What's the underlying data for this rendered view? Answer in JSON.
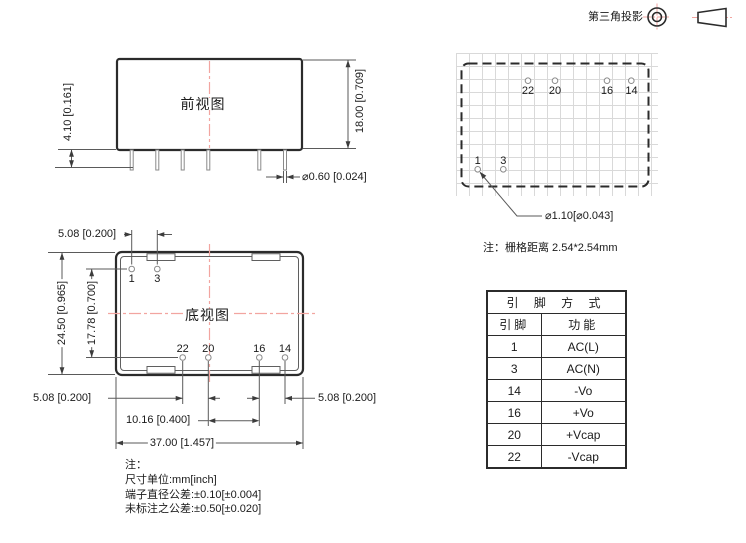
{
  "header": {
    "projection_label": "第三角投影"
  },
  "front_view": {
    "title": "前视图",
    "dim_pin_length": "4.10 [0.161]",
    "dim_body_height": "18.00 [0.709]",
    "dim_pin_diameter": "⌀0.60 [0.024]"
  },
  "grid_view": {
    "top_pin_labels": [
      "22",
      "20",
      "16",
      "14"
    ],
    "bottom_pin_labels": [
      "1",
      "3"
    ],
    "dim_hole_diameter": "⌀1.10[⌀0.043]",
    "note": "注：栅格距离 2.54*2.54mm"
  },
  "bottom_view": {
    "title": "底视图",
    "top_pin_labels": [
      "1",
      "3"
    ],
    "bottom_pin_labels": [
      "22",
      "20",
      "16",
      "14"
    ],
    "dim_pitch_top": "5.08 [0.200]",
    "dim_body_height": "24.50 [0.965]",
    "dim_row_pitch": "17.78 [0.700]",
    "dim_pitch_bottom_left": "5.08 [0.200]",
    "dim_pitch_bottom_mid": "10.16 [0.400]",
    "dim_pitch_bottom_right": "5.08 [0.200]",
    "dim_body_width": "37.00 [1.457]"
  },
  "notes": {
    "title": "注：",
    "lines": [
      "尺寸单位:mm[inch]",
      "端子直径公差:±0.10[±0.004]",
      "未标注之公差:±0.50[±0.020]"
    ]
  },
  "pin_table": {
    "title": "引 脚 方 式",
    "col_pin": "引脚",
    "col_func": "功能",
    "rows": [
      {
        "pin": "1",
        "func": "AC(L)"
      },
      {
        "pin": "3",
        "func": "AC(N)"
      },
      {
        "pin": "14",
        "func": "-Vo"
      },
      {
        "pin": "16",
        "func": "+Vo"
      },
      {
        "pin": "20",
        "func": "+Vcap"
      },
      {
        "pin": "22",
        "func": "-Vcap"
      }
    ]
  },
  "colors": {
    "outline": "#2b2b2b",
    "thin_line": "#6a6a6a",
    "centerline_red": "#f2a5a0",
    "grid_gray": "#d9d9d9"
  }
}
